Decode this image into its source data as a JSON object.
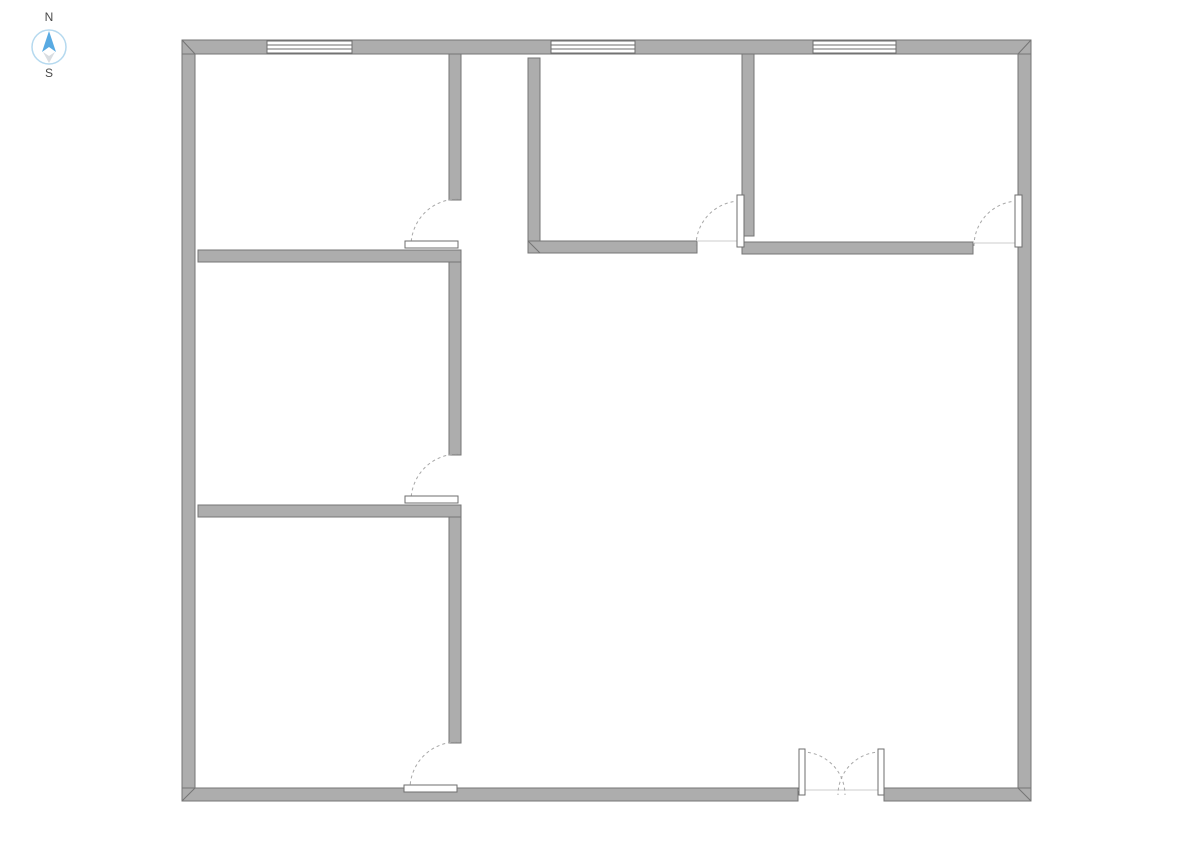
{
  "canvas": {
    "width": 1191,
    "height": 842,
    "background": "#ffffff"
  },
  "compass": {
    "north_label": "N",
    "south_label": "S",
    "cx": 49,
    "cy": 47,
    "radius": 17,
    "ring_color": "#b5d9ef",
    "north_color": "#58aae2",
    "south_color": "#d9dde1",
    "label_color": "#4a4a4a"
  },
  "colors": {
    "wall_fill": "#adadad",
    "wall_stroke": "#757575",
    "window_fill": "#ffffff",
    "window_stroke": "#6e6e6e",
    "door_leaf_fill": "#ffffff",
    "door_leaf_stroke": "#6e6e6e",
    "swing_arc": "#a8a8a8",
    "threshold": "#cccccc"
  },
  "floor_plan": {
    "walls": [
      {
        "id": "exterior-top",
        "x": 182,
        "y": 40,
        "w": 849,
        "h": 14
      },
      {
        "id": "exterior-left",
        "x": 182,
        "y": 54,
        "w": 13,
        "h": 734
      },
      {
        "id": "exterior-right",
        "x": 1018,
        "y": 54,
        "w": 13,
        "h": 734
      },
      {
        "id": "exterior-bottom-left",
        "x": 182,
        "y": 788,
        "w": 616,
        "h": 13
      },
      {
        "id": "exterior-bottom-right",
        "x": 884,
        "y": 788,
        "w": 147,
        "h": 13
      },
      {
        "id": "interior-left-column-top",
        "x": 449,
        "y": 54,
        "w": 12,
        "h": 146
      },
      {
        "id": "interior-left-column-middle",
        "x": 449,
        "y": 250,
        "w": 12,
        "h": 205
      },
      {
        "id": "interior-left-column-bottom",
        "x": 449,
        "y": 505,
        "w": 12,
        "h": 238
      },
      {
        "id": "interior-left-divider-upper",
        "x": 198,
        "y": 250,
        "w": 263,
        "h": 12
      },
      {
        "id": "interior-left-divider-lower",
        "x": 198,
        "y": 505,
        "w": 263,
        "h": 12
      },
      {
        "id": "interior-room-a-left",
        "x": 528,
        "y": 58,
        "w": 12,
        "h": 195
      },
      {
        "id": "interior-room-a-bottom",
        "x": 528,
        "y": 241,
        "w": 169,
        "h": 12
      },
      {
        "id": "interior-room-divider",
        "x": 742,
        "y": 54,
        "w": 12,
        "h": 182
      },
      {
        "id": "interior-room-b-bottom",
        "x": 742,
        "y": 242,
        "w": 231,
        "h": 12
      }
    ],
    "miters": [
      [
        182,
        40,
        195,
        54
      ],
      [
        1031,
        40,
        1018,
        54
      ],
      [
        182,
        801,
        195,
        788
      ],
      [
        1031,
        801,
        1018,
        788
      ],
      [
        528,
        241,
        540,
        253
      ]
    ],
    "windows": [
      {
        "id": "window-1",
        "x": 267,
        "y": 41,
        "w": 85,
        "h": 12
      },
      {
        "id": "window-2",
        "x": 551,
        "y": 41,
        "w": 84,
        "h": 12
      },
      {
        "id": "window-3",
        "x": 813,
        "y": 41,
        "w": 83,
        "h": 12
      }
    ],
    "doors": [
      {
        "id": "door-left-upper",
        "leaf": {
          "x": 405,
          "y": 241,
          "w": 53,
          "h": 7
        },
        "arc": "M 458 199 A 47 47 0 0 0 411 246",
        "threshold": null
      },
      {
        "id": "door-left-middle",
        "leaf": {
          "x": 405,
          "y": 496,
          "w": 53,
          "h": 7
        },
        "arc": "M 458 454 A 47 47 0 0 0 411 501",
        "threshold": null
      },
      {
        "id": "door-left-lower",
        "leaf": {
          "x": 404,
          "y": 785,
          "w": 53,
          "h": 7
        },
        "arc": "M 457 742 A 47 47 0 0 0 410 789",
        "threshold": null
      },
      {
        "id": "door-room-a",
        "leaf": {
          "x": 737,
          "y": 195,
          "w": 7,
          "h": 52
        },
        "arc": "M 696 246 A 45 45 0 0 1 741 201",
        "threshold": [
          697,
          241,
          737,
          241
        ]
      },
      {
        "id": "door-room-b",
        "leaf": {
          "x": 1015,
          "y": 195,
          "w": 7,
          "h": 52
        },
        "arc": "M 974 246 A 45 45 0 0 1 1019 201",
        "threshold": [
          973,
          243,
          1015,
          243
        ]
      },
      {
        "id": "double-door-left-leaf",
        "leaf": {
          "x": 799,
          "y": 749,
          "w": 6,
          "h": 46
        },
        "arc": "M 802 752 A 43 43 0 0 1 845 795",
        "threshold": [
          798,
          790,
          884,
          790
        ]
      },
      {
        "id": "double-door-right-leaf",
        "leaf": {
          "x": 878,
          "y": 749,
          "w": 6,
          "h": 46
        },
        "arc": "M 881 752 A 43 43 0 0 0 838 795",
        "threshold": null
      }
    ]
  }
}
